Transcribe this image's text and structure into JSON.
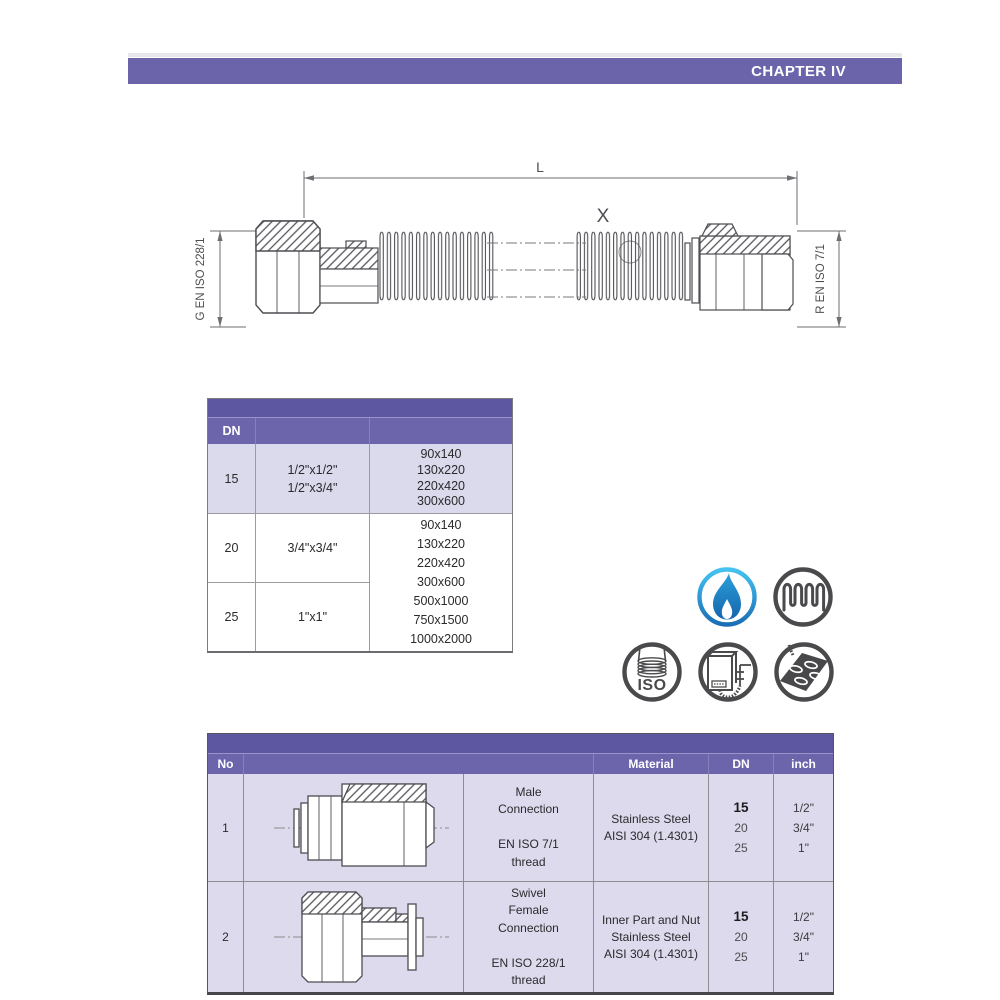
{
  "page": {
    "chapter_title": "CHAPTER IV"
  },
  "colors": {
    "header_purple": "#6b64ab",
    "band_purple": "#5d57a1",
    "row_light_purple": "#dbd9ec",
    "drawing_line_gray": "#4d4e52",
    "icon_gray": "#4a4a4c",
    "flame_blue_light": "#45c2f1",
    "flame_blue_dark": "#1b6eb5"
  },
  "diagram": {
    "length_label": "L",
    "detail_label": "X",
    "left_thread_label": "G EN ISO 228/1",
    "right_thread_label": "R EN ISO 7/1"
  },
  "size_table": {
    "col_dn_header": "DN",
    "rows": [
      {
        "dn": "15",
        "sizes": [
          "1/2\"x1/2\"",
          "1/2\"x3/4\""
        ],
        "dims": [
          "90x140",
          "130x220",
          "220x420",
          "300x600"
        ]
      },
      {
        "dn": "20",
        "sizes": [
          "3/4\"x3/4\""
        ]
      },
      {
        "dn": "25",
        "sizes": [
          "1\"x1\""
        ]
      }
    ],
    "merged_dims": [
      "90x140",
      "130x220",
      "220x420",
      "300x600",
      "500x1000",
      "750x1500",
      "1000x2000"
    ]
  },
  "icons": [
    {
      "name": "gas-flame-icon"
    },
    {
      "name": "corrugated-hose-icon"
    },
    {
      "name": "iso-hose-icon",
      "label": "ISO"
    },
    {
      "name": "gas-boiler-icon"
    },
    {
      "name": "gas-cooktop-icon"
    }
  ],
  "parts_table": {
    "headers": {
      "no": "No",
      "material": "Material",
      "dn": "DN",
      "inch": "inch"
    },
    "rows": [
      {
        "no": "1",
        "description": [
          "Male",
          "Connection",
          "",
          "EN ISO 7/1",
          "thread"
        ],
        "material": [
          "Stainless Steel",
          "AISI 304 (1.4301)"
        ],
        "dn_primary": "15",
        "dn_rest": [
          "20",
          "25"
        ],
        "inch": [
          "1/2\"",
          "3/4\"",
          "1\""
        ]
      },
      {
        "no": "2",
        "description": [
          "Swivel",
          "Female",
          "Connection",
          "",
          "EN ISO 228/1",
          "thread"
        ],
        "material": [
          "Inner Part and Nut",
          "Stainless Steel",
          "AISI 304 (1.4301)"
        ],
        "dn_primary": "15",
        "dn_rest": [
          "20",
          "25"
        ],
        "inch": [
          "1/2\"",
          "3/4\"",
          "1\""
        ]
      }
    ]
  }
}
